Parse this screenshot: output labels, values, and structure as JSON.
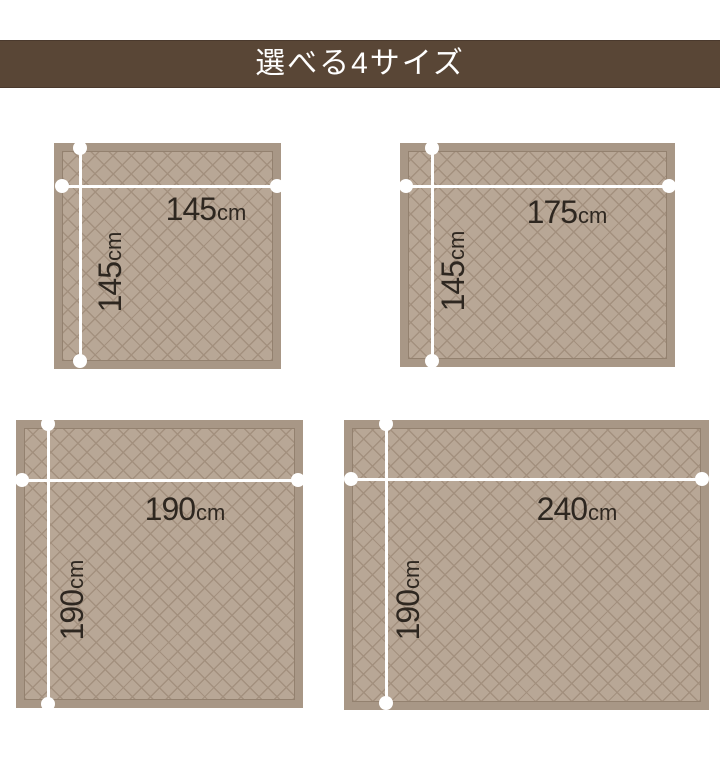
{
  "banner": {
    "title": "選べる4サイズ"
  },
  "unit": "cm",
  "sizes": [
    {
      "width_value": "145",
      "height_value": "145"
    },
    {
      "width_value": "175",
      "height_value": "145"
    },
    {
      "width_value": "190",
      "height_value": "190"
    },
    {
      "width_value": "240",
      "height_value": "190"
    }
  ],
  "colors": {
    "banner_bg": "#594636",
    "banner_text": "#ffffff",
    "page_bg": "#ffffff",
    "rug_border": "#a89786",
    "rug_fill": "#b8a796",
    "rug_lattice": "#a3907e",
    "dimension_line": "#ffffff",
    "label_text": "#2e2720"
  }
}
